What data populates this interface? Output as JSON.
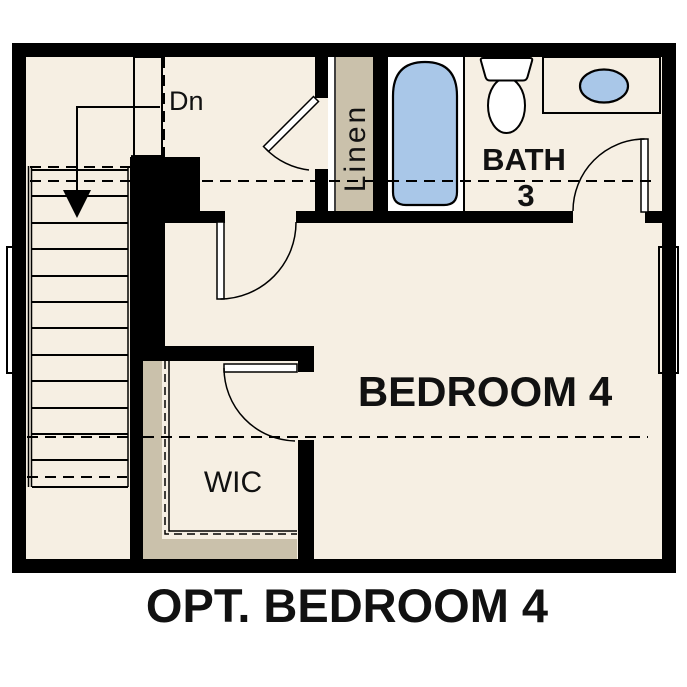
{
  "title": "OPT. BEDROOM 4",
  "rooms": {
    "bedroom": {
      "label": "BEDROOM 4"
    },
    "bath": {
      "label": "BATH",
      "number": "3"
    },
    "wic": {
      "label": "WIC"
    },
    "linen": {
      "label": "Linen"
    },
    "stairs": {
      "label": "Dn"
    }
  },
  "fixtures": [
    "bathtub",
    "toilet",
    "sink",
    "vanity-counter",
    "stairs-down-arrow",
    "linen-shelf",
    "wic-shelves",
    "windows",
    "hinged-doors",
    "stair-railing"
  ],
  "colors": {
    "wall": "#000000",
    "floor": "#f6efe3",
    "cabinet": "#cac1ab",
    "fixture-white": "#ffffff",
    "fixture-blue": "#a9c7e8",
    "line": "#000000",
    "background": "#ffffff",
    "text": "#111111"
  }
}
